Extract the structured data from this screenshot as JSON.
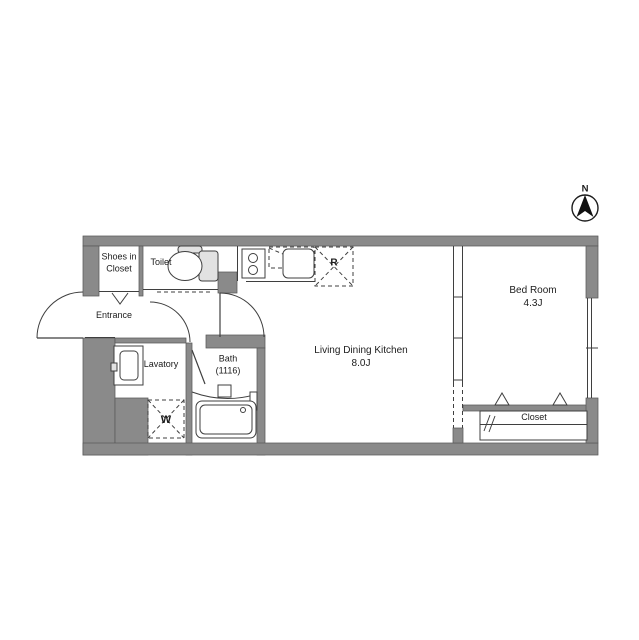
{
  "drawing": {
    "kind": "apartment-floor-plan",
    "compass": {
      "label": "N"
    },
    "rooms": {
      "shoes_closet": {
        "label": "Shoes in\nCloset"
      },
      "toilet": {
        "label": "Toilet"
      },
      "entrance": {
        "label": "Entrance"
      },
      "lavatory": {
        "label": "Lavatory"
      },
      "bath": {
        "label": "Bath\n(1116)"
      },
      "ldk": {
        "label": "Living Dining Kitchen\n8.0J"
      },
      "bedroom": {
        "label": "Bed Room\n4.3J"
      },
      "closet": {
        "label": "Closet"
      }
    },
    "fixtures": {
      "washing_machine_space": {
        "label": "W"
      },
      "refrigerator_space": {
        "label": "R"
      }
    },
    "colors": {
      "wall": "#8a8a8a",
      "line": "#3f3f3f",
      "text": "#1c1c1c"
    }
  }
}
